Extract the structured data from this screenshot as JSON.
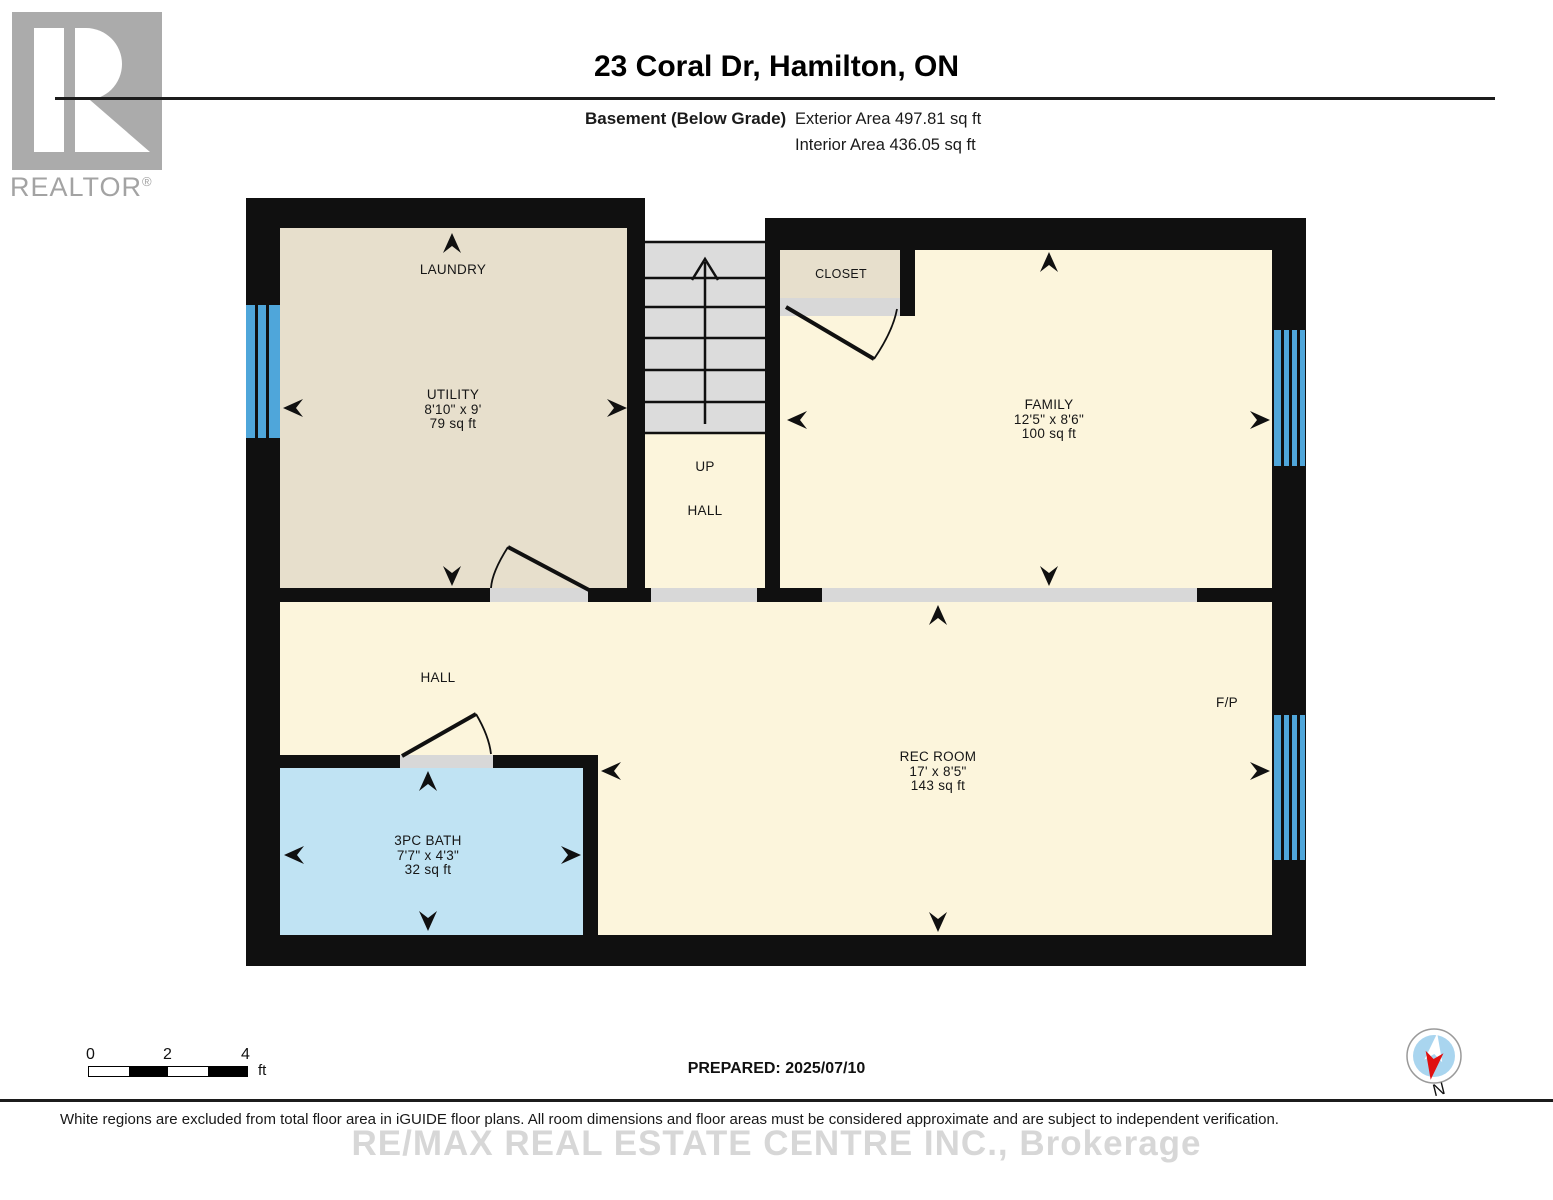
{
  "header": {
    "logo_letter": "R",
    "logo_word": "REALTOR",
    "logo_reg": "®",
    "title": "23 Coral Dr, Hamilton, ON",
    "floor_label": "Basement (Below Grade)",
    "exterior_area": "Exterior Area 497.81 sq ft",
    "interior_area": "Interior Area 436.05 sq ft"
  },
  "rooms": {
    "laundry": {
      "label": "LAUNDRY"
    },
    "utility": {
      "name": "UTILITY",
      "dims": "8'10\" x 9'",
      "area": "79 sq ft"
    },
    "closet": {
      "name": "CLOSET"
    },
    "family": {
      "name": "FAMILY",
      "dims": "12'5\" x 8'6\"",
      "area": "100 sq ft"
    },
    "stair_hall": {
      "up": "UP",
      "hall": "HALL"
    },
    "hall": {
      "name": "HALL"
    },
    "rec_room": {
      "name": "REC ROOM",
      "dims": "17' x 8'5\"",
      "area": "143 sq ft"
    },
    "bath": {
      "name": "3PC BATH",
      "dims": "7'7\" x 4'3\"",
      "area": "32 sq ft"
    },
    "fireplace": {
      "label": "F/P"
    }
  },
  "scale_bar": {
    "tick0": "0",
    "tick2": "2",
    "tick4": "4",
    "unit": "ft"
  },
  "footer": {
    "prepared": "PREPARED: 2025/07/10",
    "compass_label": "N",
    "disclaimer": "White regions are excluded from total floor area in iGUIDE floor plans. All room dimensions and floor areas must be considered approximate and are subject to independent verification.",
    "watermark": "RE/MAX REAL ESTATE CENTRE INC., Brokerage"
  },
  "colors": {
    "wall": "#101010",
    "room_cream": "#fcf5dc",
    "room_tan": "#e7dfcc",
    "bath_blue": "#c0e3f3",
    "window_blue": "#4fa6da",
    "stairs_gray": "#dcdcdc",
    "opening_gray": "#d8d8d8",
    "logo_gray": "#ababab"
  },
  "icons": {
    "compass": "compass-icon",
    "dimension_arrow": "dimension-arrow-icon",
    "stairs_up_arrow": "stairs-up-arrow-icon",
    "realtor_logo": "realtor-logo-icon"
  }
}
